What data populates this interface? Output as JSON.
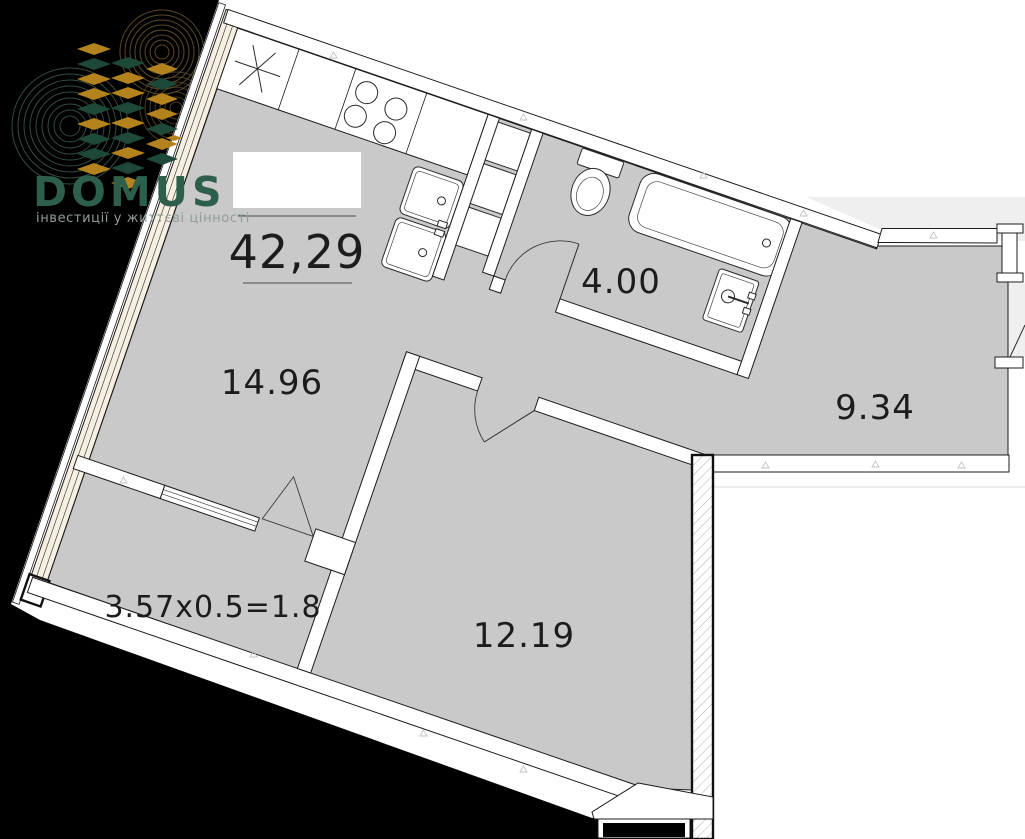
{
  "branding": {
    "logo_text": "DOMUS",
    "tagline": "інвестиції у життєві цінності"
  },
  "plan": {
    "total_area_label": "42,29",
    "rooms": [
      {
        "id": "living-kitchen",
        "area_label": "14.96"
      },
      {
        "id": "bathroom",
        "area_label": "4.00"
      },
      {
        "id": "hallway",
        "area_label": "9.34"
      },
      {
        "id": "bedroom",
        "area_label": "12.19"
      },
      {
        "id": "balcony",
        "area_label": "3.57x0.5=1.8"
      }
    ],
    "fixtures": [
      "fridge-star",
      "stove-burners",
      "kitchen-double-sink",
      "shaft-cabinets",
      "toilet",
      "bathtub",
      "washbasin",
      "balcony-door-triangle",
      "entrance-door-swing"
    ]
  },
  "colors": {
    "background": "#000000",
    "floor_gray": "#c9c9c9",
    "adjacent_gray": "#efefef",
    "walls_white": "#ffffff",
    "line_black": "#1c1c1c",
    "glazing_tint": "#f7efe1",
    "logo_green": "#2d5f4b",
    "logo_gold": "#b5831d",
    "logo_block_green": "#1e4939",
    "tagline_gray": "#8f9e97"
  }
}
